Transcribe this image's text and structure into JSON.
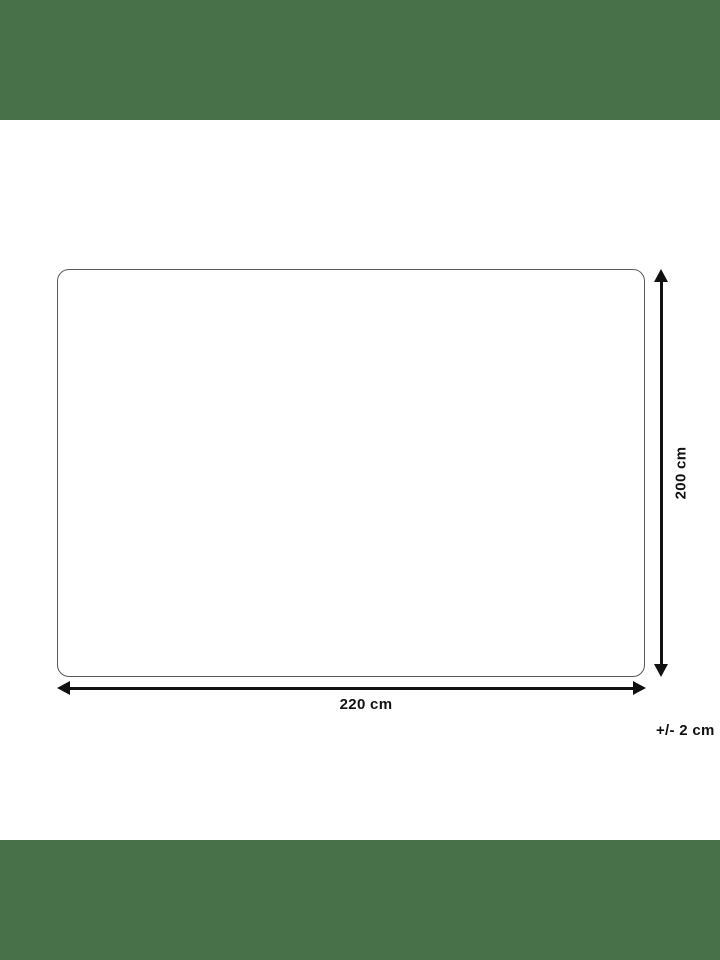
{
  "colors": {
    "letterbox_green": "#48714A",
    "outline_gray": "#5A5A5A",
    "ink": "#111111"
  },
  "diagram": {
    "height_label": "200 cm",
    "width_label": "220 cm",
    "tolerance_label": "+/- 2 cm"
  }
}
